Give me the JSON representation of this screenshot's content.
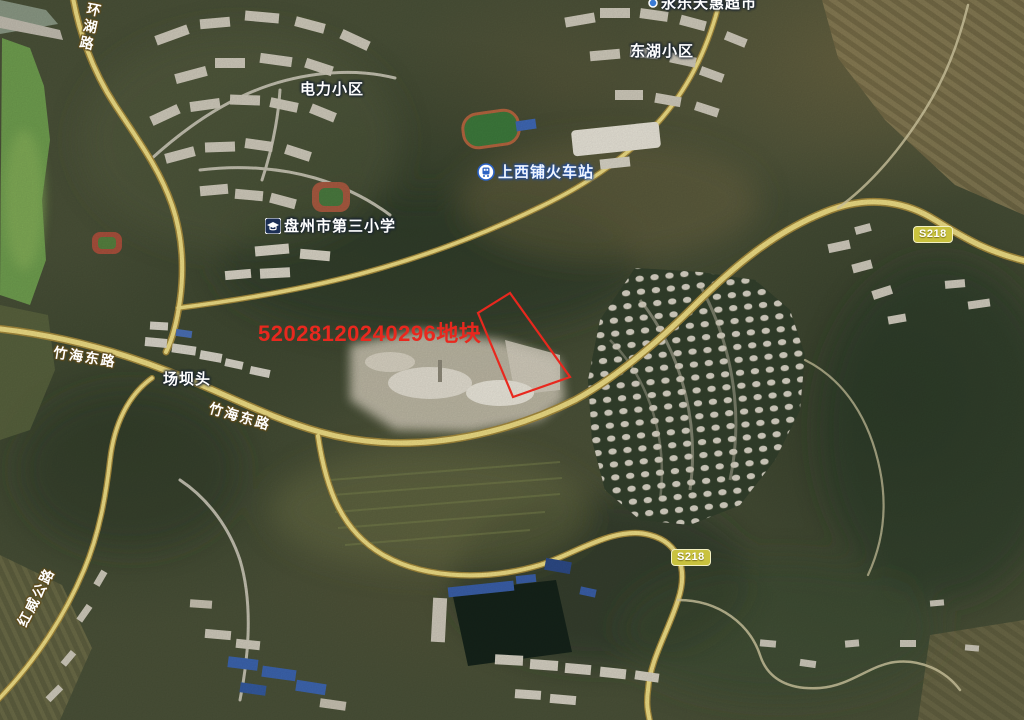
{
  "map_type": "satellite",
  "parcel": {
    "label": "52028120240296地块",
    "points": "510,293 570,377 513,397 478,313",
    "outline_color": "#e8281e",
    "label_color": "#e8281e"
  },
  "places": {
    "supermarket": {
      "label": "永乐天惠超市",
      "icon": "poi-dot-icon"
    },
    "donghu": {
      "label": "东湖小区"
    },
    "dianli": {
      "label": "电力小区"
    },
    "station": {
      "label": "上西铺火车站",
      "icon": "train-station-icon"
    },
    "school": {
      "label": "盘州市第三小学",
      "icon": "school-icon"
    },
    "changbatou": {
      "label": "场坝头"
    }
  },
  "roads": {
    "huanhu": {
      "label": "环湖路"
    },
    "zhuhai_west": {
      "label": "竹海东路"
    },
    "zhuhai_east": {
      "label": "竹海东路"
    },
    "hongwei": {
      "label": "红威公路"
    },
    "badge_northeast": {
      "label": "S218"
    },
    "badge_south": {
      "label": "S218"
    }
  },
  "colors": {
    "road_fill": "#eedd84",
    "road_casing": "#a3893c",
    "badge_background": "#c9c23e",
    "parcel_red": "#e8281e",
    "water_green": "#6f9e4f"
  }
}
